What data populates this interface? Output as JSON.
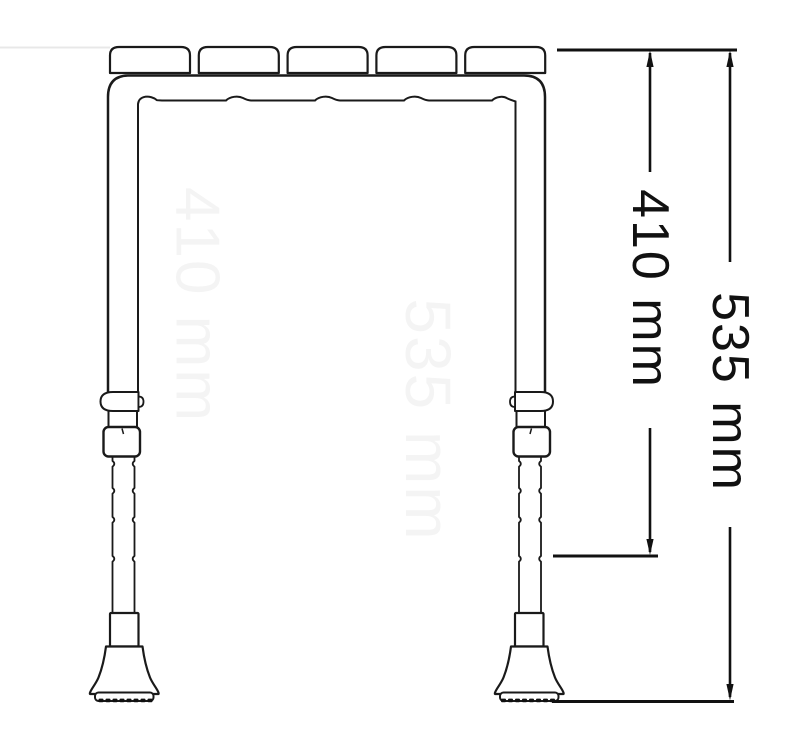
{
  "diagram": {
    "type": "technical-dimension-drawing",
    "subject": "height-adjustable stool frame, front view",
    "units": "mm"
  },
  "dimensions": {
    "inner_height": {
      "label": "410 mm",
      "value": 410,
      "unit": "mm"
    },
    "overall_height": {
      "label": "535 mm",
      "value": 535,
      "unit": "mm"
    }
  },
  "watermarks": {
    "inner_height_ghost": "410 mm",
    "overall_height_ghost": "535 mm"
  },
  "colors": {
    "line": "#1a1a1a",
    "dimension_line": "#111111",
    "ghost": "#f4f4f4",
    "ghost_line": "#e8e8e8",
    "background": "#ffffff"
  }
}
